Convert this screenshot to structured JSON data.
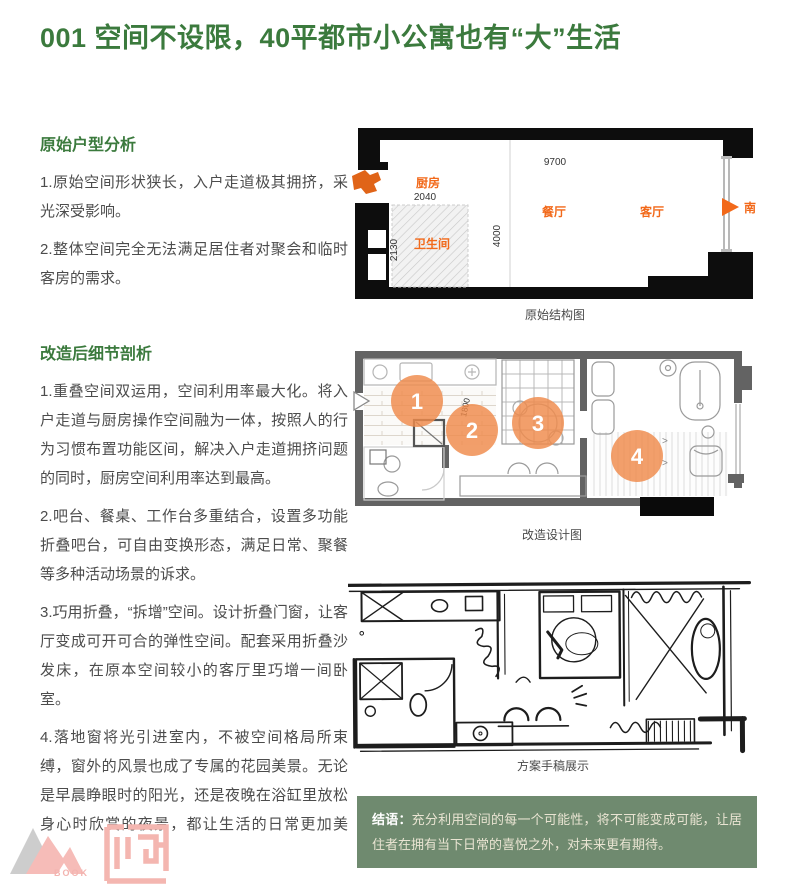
{
  "title": "001 空间不设限，40平都市小公寓也有“大”生活",
  "sections": [
    {
      "heading": "原始户型分析",
      "paragraphs": [
        "1.原始空间形状狭长，入户走道极其拥挤，采光深受影响。",
        "2.整体空间完全无法满足居住者对聚会和临时客房的需求。"
      ]
    },
    {
      "heading": "改造后细节剖析",
      "paragraphs": [
        "1.重叠空间双运用，空间利用率最大化。将入户走道与厨房操作空间融为一体，按照人的行为习惯布置功能区间，解决入户走道拥挤问题的同时，厨房空间利用率达到最高。",
        "2.吧台、餐桌、工作台多重结合，设置多功能折叠吧台，可自由变换形态，满足日常、聚餐等多种活动场景的诉求。",
        "3.巧用折叠，“拆增”空间。设计折叠门窗，让客厅变成可开可合的弹性空间。配套采用折叠沙发床，在原本空间较小的客厅里巧增一间卧室。",
        "4.落地窗将光引进室内，不被空间格局所束缚，窗外的风景也成了专属的花园美景。无论是早晨睁眼时的阳光，还是夜晚在浴缸里放松身心时欣赏的夜景，都让生活的日常更加美好。"
      ]
    }
  ],
  "figures": [
    {
      "caption": "原始结构图",
      "labels": {
        "kitchen": "厨房",
        "dining": "餐厅",
        "living": "客厅",
        "bathroom": "卫生间",
        "south": "南"
      },
      "dimensions": {
        "total_width": "9700",
        "depth": "4000",
        "bath_width": "2040",
        "bath_height": "2130"
      }
    },
    {
      "caption": "改造设计图",
      "markers": [
        "1",
        "2",
        "3",
        "4"
      ],
      "dimension": "1800"
    },
    {
      "caption": "方案手稿展示"
    }
  ],
  "conclusion": {
    "label": "结语：",
    "text": "充分利用空间的每一个可能性，将不可能变成可能，让居住者在拥有当下日常的喜悦之外，对未来更有期待。"
  },
  "logos": {
    "book_label": "BOOK"
  },
  "colors": {
    "accent_green": "#3b7a3d",
    "label_orange": "#f2691a",
    "marker_orange": "#ef8a4a",
    "box_green": "#6f8a6f",
    "logo_pink": "#f4b6b0"
  }
}
